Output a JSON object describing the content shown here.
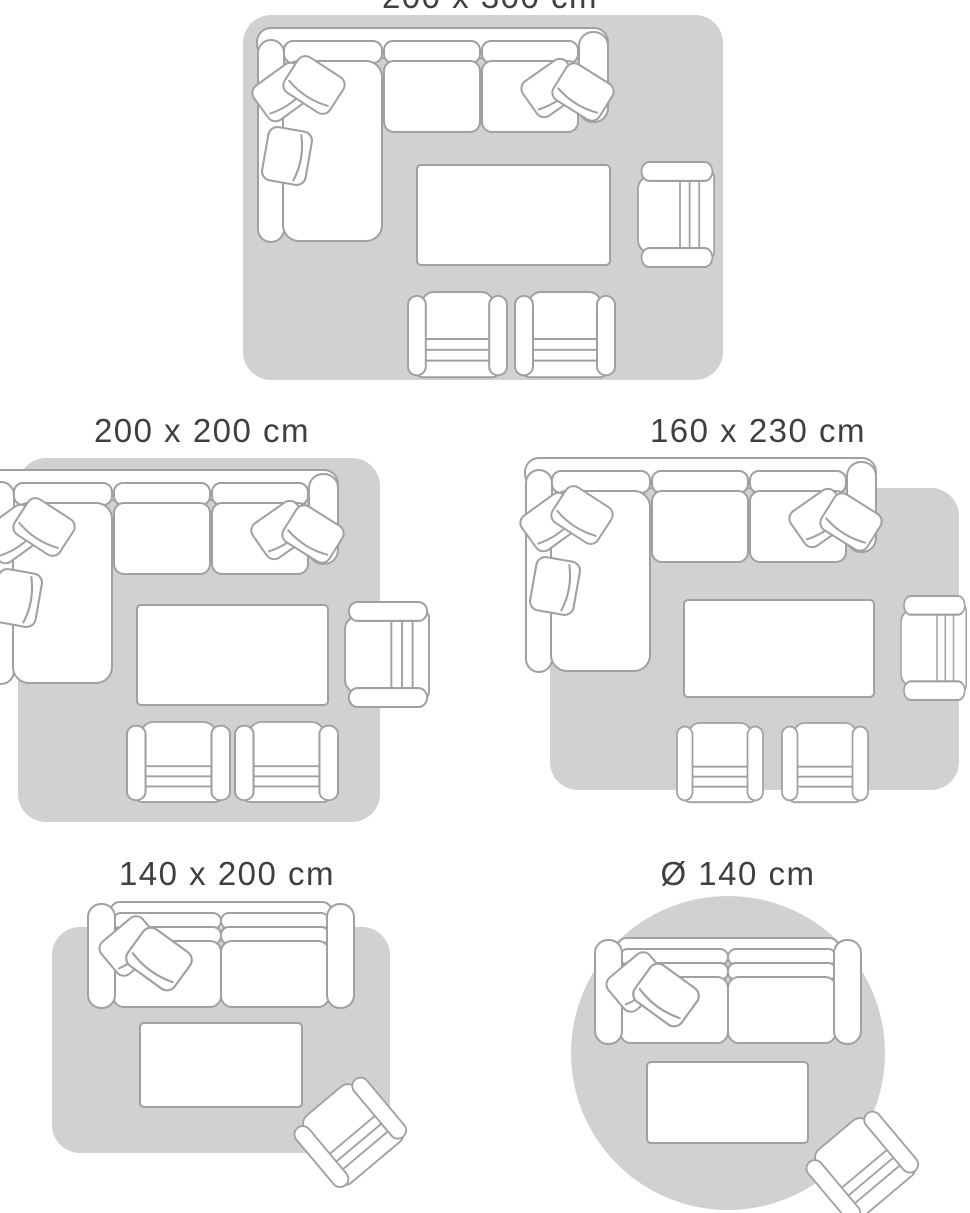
{
  "page": {
    "title": "Rug size guide"
  },
  "colors": {
    "page_bg": "#ffffff",
    "rug": "#d1d1d1",
    "furniture_outline": "#a0a0a0",
    "furniture_fill": "#ffffff",
    "label_text": "#3f3f3f"
  },
  "size_guide": {
    "diagrams": [
      {
        "label": "200 x 300 cm",
        "rug_shape": "rectangle",
        "label_truncated_at_top": true,
        "furniture": [
          "corner-sofa-with-cushions",
          "coffee-table",
          "armchair-facing-left",
          "armchair-facing-up",
          "armchair-facing-up"
        ]
      },
      {
        "label": "200 x 200 cm",
        "rug_shape": "square",
        "furniture": [
          "corner-sofa-with-cushions",
          "coffee-table",
          "armchair-facing-left",
          "armchair-facing-up",
          "armchair-facing-up"
        ]
      },
      {
        "label": "160 x 230 cm",
        "rug_shape": "rectangle",
        "furniture": [
          "corner-sofa-with-cushions",
          "coffee-table",
          "armchair-facing-left",
          "armchair-facing-up",
          "armchair-facing-up"
        ]
      },
      {
        "label": "140 x 200 cm",
        "rug_shape": "rectangle",
        "furniture": [
          "two-seat-sofa-with-cushions",
          "coffee-table",
          "armchair-angled"
        ]
      },
      {
        "label": "Ø 140 cm",
        "rug_shape": "circle",
        "furniture": [
          "two-seat-sofa-with-cushions",
          "coffee-table",
          "armchair-angled"
        ]
      }
    ]
  }
}
